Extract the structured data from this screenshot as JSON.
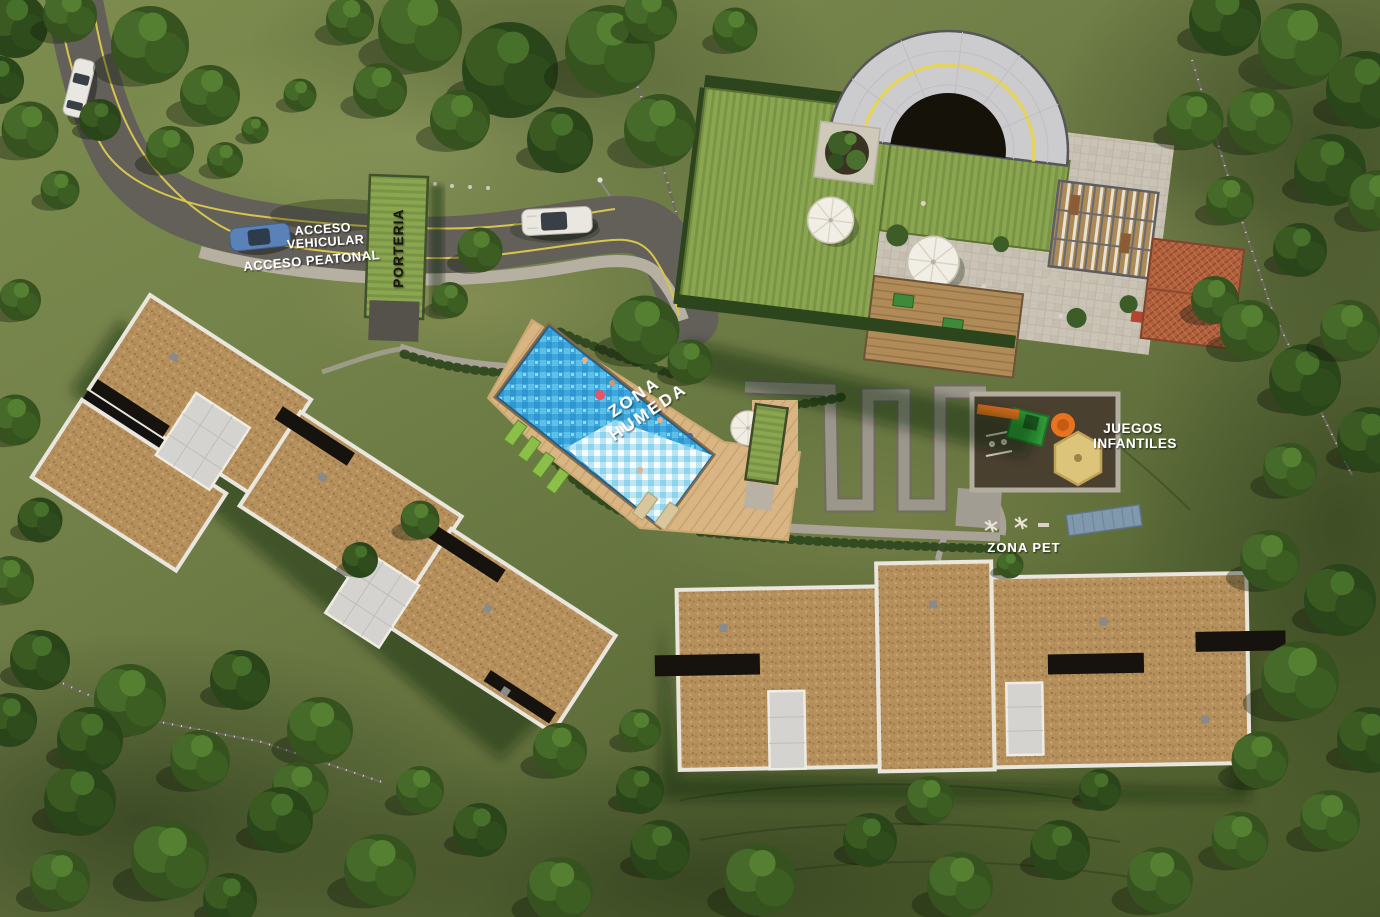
{
  "site_labels": {
    "acceso_vehicular_line1": "ACCESO",
    "acceso_vehicular_line2": "VEHICULAR",
    "acceso_peatonal": "ACCESO PEATONAL",
    "porteria": "PORTERIA",
    "zona_humeda_line1": "ZONA",
    "zona_humeda_line2": "HUMEDA",
    "juegos_infantiles_line1": "JUEGOS",
    "juegos_infantiles_line2": "INFANTILES",
    "zona_pet": "ZONA PET"
  },
  "colors": {
    "grass": "#74834a",
    "forest_canopy": "#35521f",
    "road_asphalt": "#63605a",
    "road_marking_yellow": "#d9c54b",
    "sidewalk": "#b6b0a2",
    "roof_gravel": "#b6905c",
    "roof_parapet_white": "#e9e6de",
    "green_roof": "#8aa651",
    "amphitheater_shell": "#cccbcd",
    "pool_water": "#3ea6da",
    "deck_wood": "#d8b583",
    "plaza_stone": "#cbc4b6",
    "red_tile_roof": "#b2603c",
    "play_equipment_orange": "#e8731f",
    "play_equipment_green": "#2f9e38",
    "sandbox_tan": "#dcc47a",
    "pet_ramp_blue": "#8099ad",
    "label_text": "#ffffff",
    "porteria_text": "#15150f"
  }
}
